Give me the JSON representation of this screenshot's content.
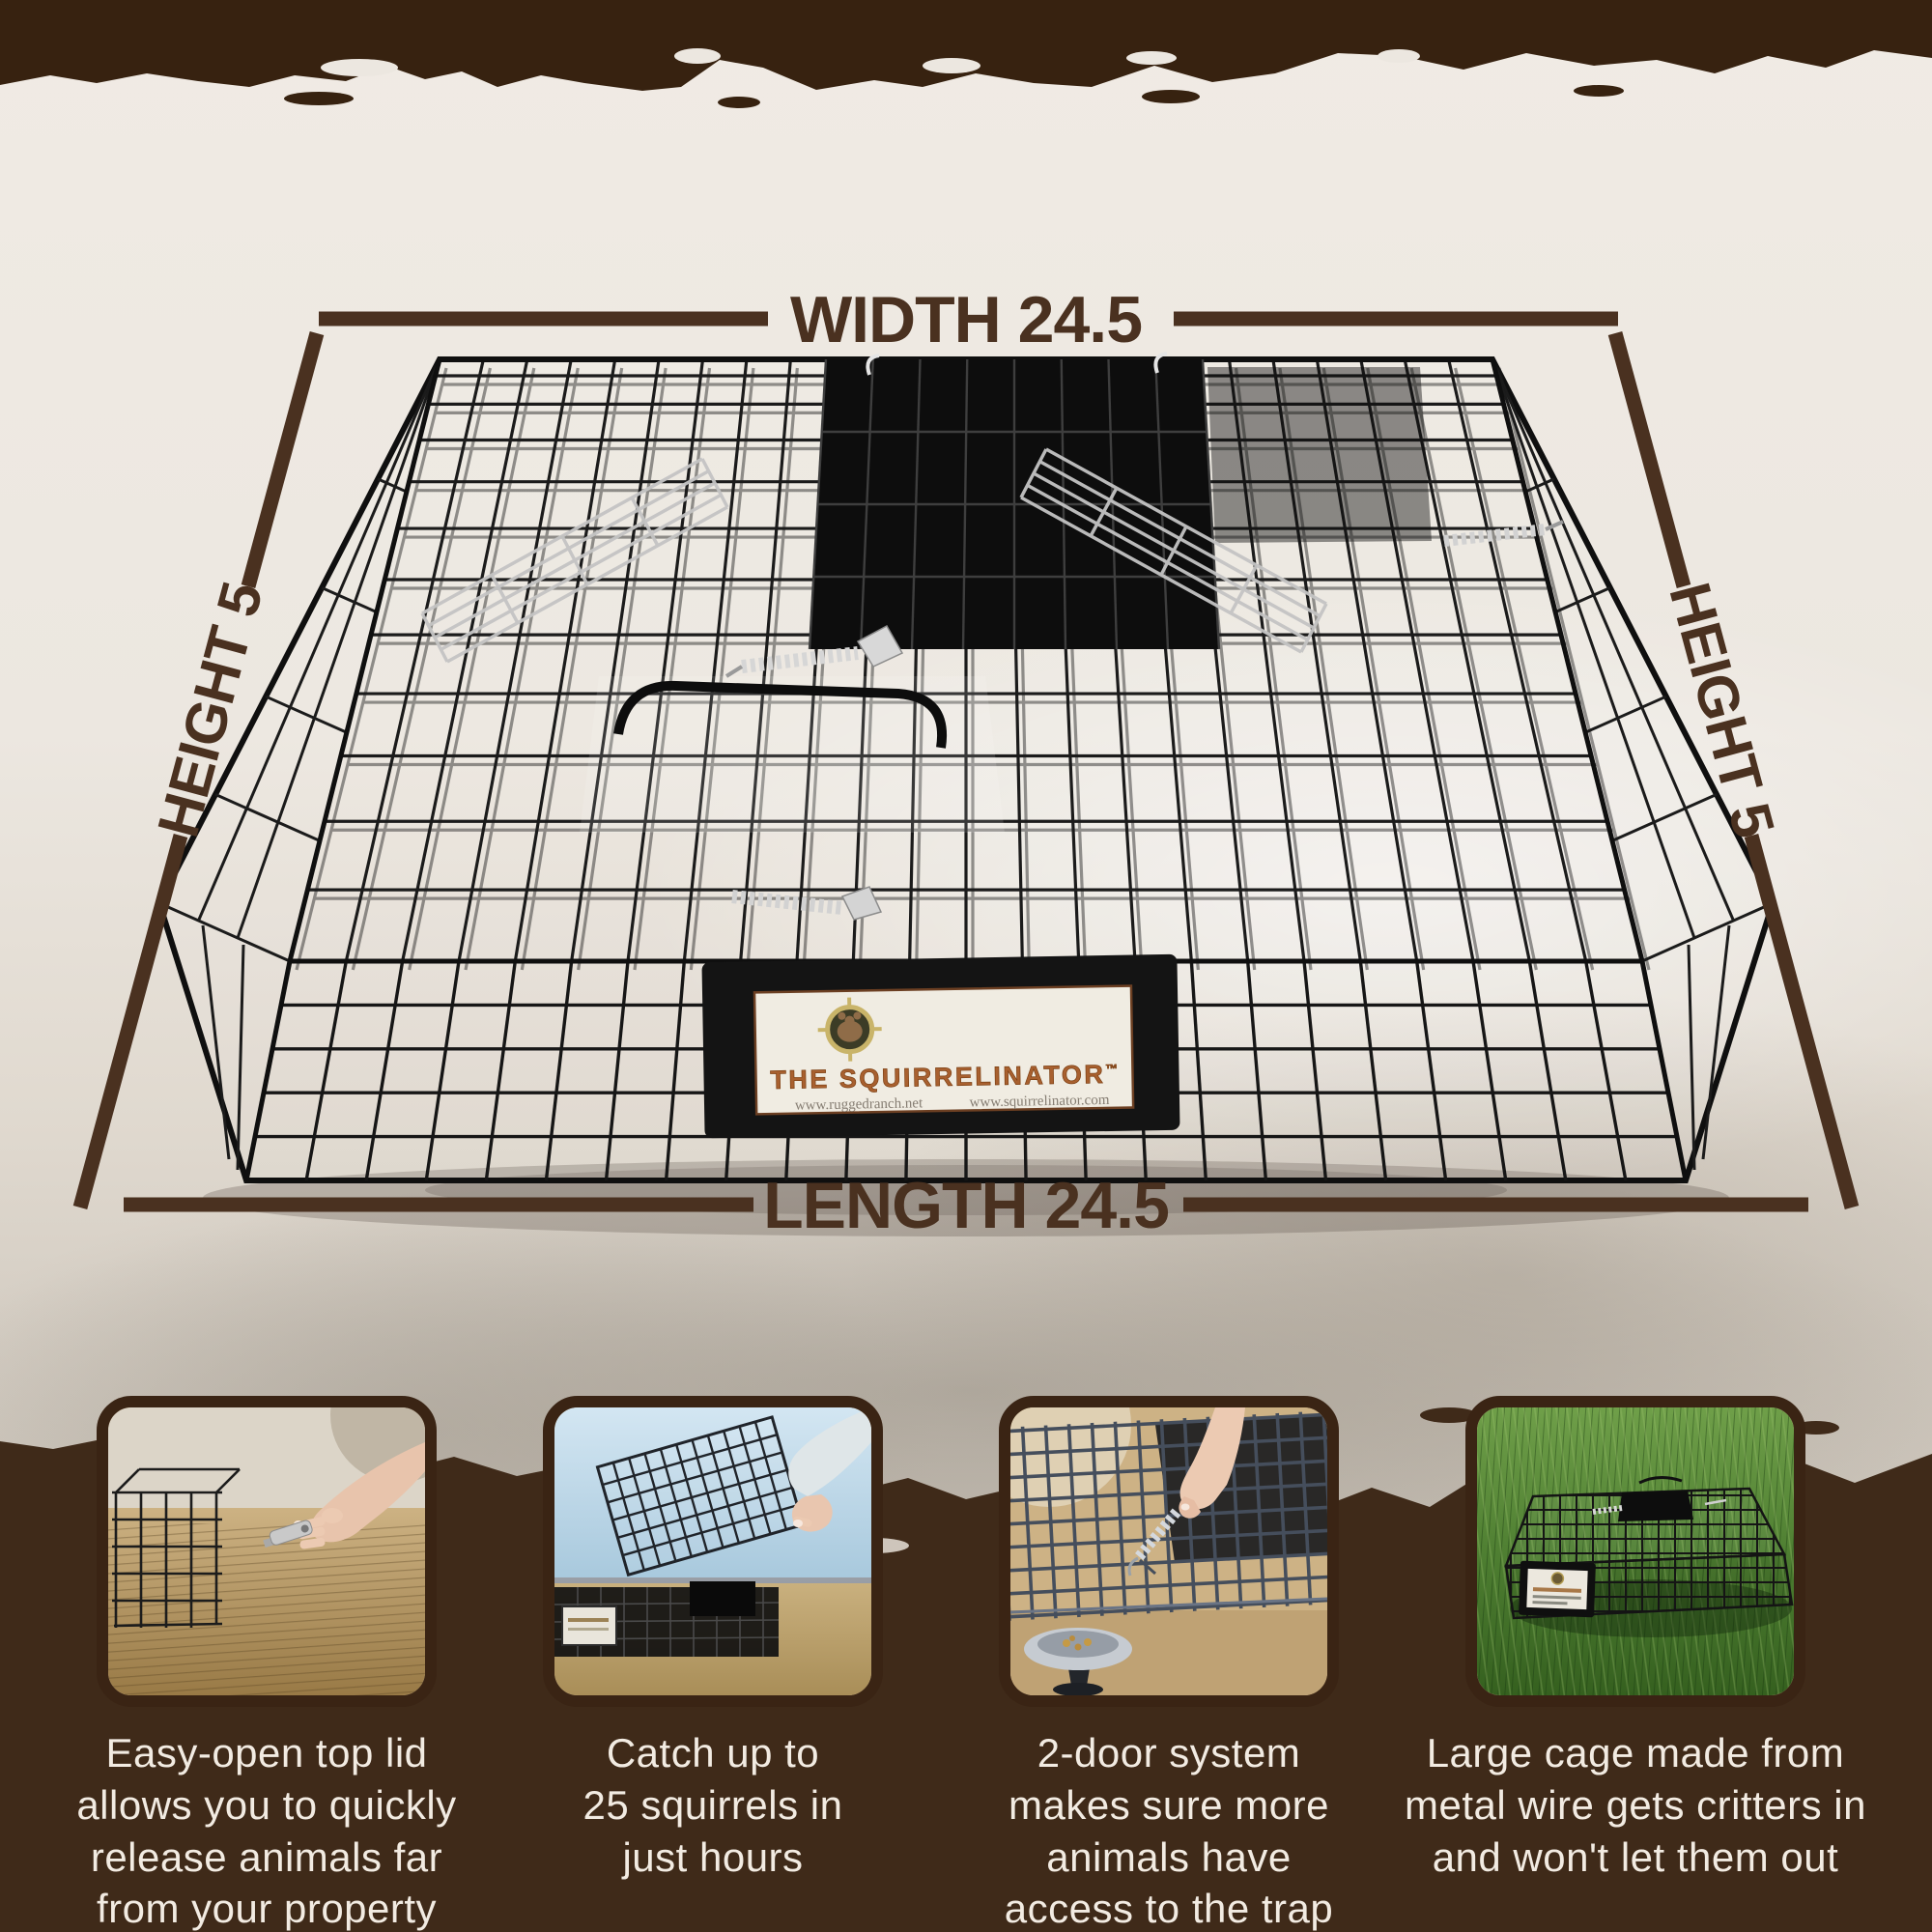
{
  "colors": {
    "band_brown": "#372210",
    "footer_brown": "#3f2a19",
    "annotation_brown": "#4a3120",
    "caption_cream": "#f2ebe2",
    "background_offwhite": "#ece7e0"
  },
  "annotations": {
    "width": "WIDTH 24.5",
    "length": "LENGTH 24.5",
    "height_left": "HEIGHT 5",
    "height_right": "HEIGHT 5"
  },
  "product_label": {
    "title": "THE SQUIRRELINATOR",
    "trademark": "™",
    "website_left": "www.ruggedranch.net",
    "website_right": "www.squirrelinator.com",
    "logo": "crosshair-squirrel-logo"
  },
  "features": [
    {
      "image": "hand-releasing-latch",
      "caption": "Easy-open top lid\nallows you to quickly\nrelease animals far\nfrom your property"
    },
    {
      "image": "hand-lifting-mesh-lid",
      "caption": "Catch up to\n25 squirrels in\njust hours"
    },
    {
      "image": "hand-pulling-spring-door",
      "caption": "2-door system\nmakes sure more\nanimals have\naccess to the trap"
    },
    {
      "image": "cage-on-green-grass",
      "caption": "Large cage made from\nmetal wire gets critters in\nand won't let them out"
    }
  ]
}
